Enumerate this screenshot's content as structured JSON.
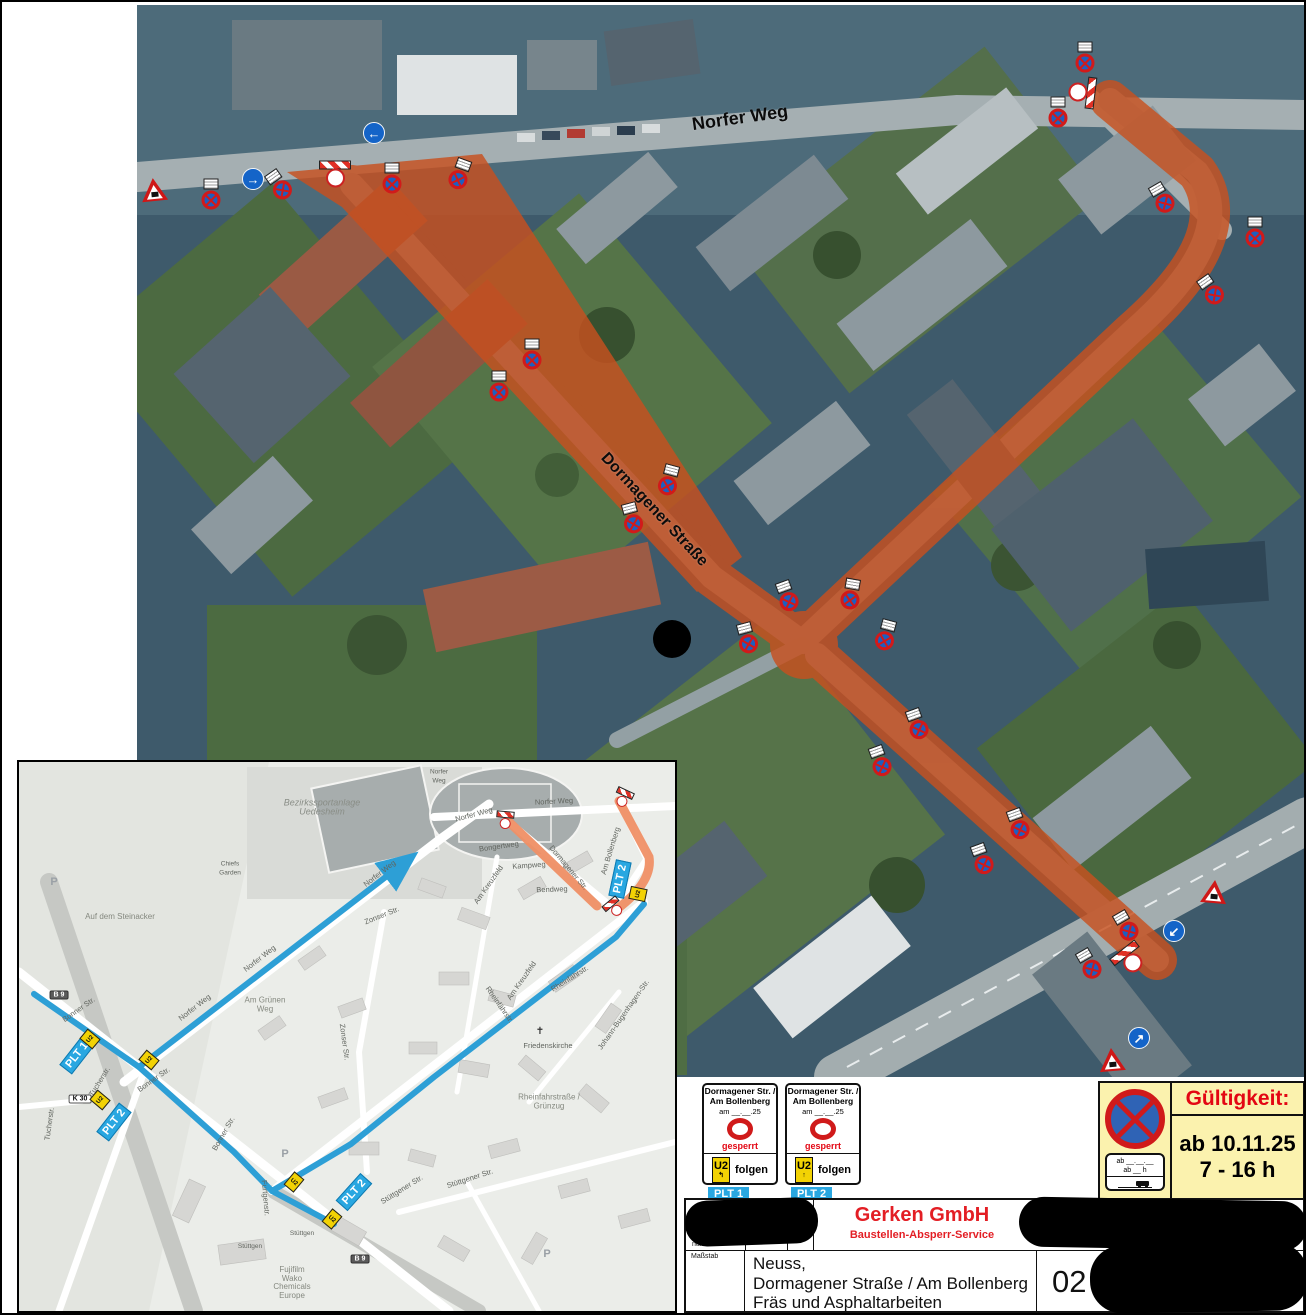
{
  "aerial": {
    "street_labels": [
      {
        "text": "Norfer Weg",
        "x": 738,
        "y": 116,
        "rot": -8,
        "size": 18
      },
      {
        "text": "Dormagener Straße",
        "x": 652,
        "y": 508,
        "rot": 47,
        "size": 16
      }
    ],
    "signs": [
      {
        "type": "triangle",
        "x": 152,
        "y": 188,
        "rot": -6
      },
      {
        "type": "nostop",
        "x": 209,
        "y": 192,
        "rot": 0,
        "plate": 1
      },
      {
        "type": "arrow",
        "x": 251,
        "y": 177,
        "dir": "→"
      },
      {
        "type": "nostop",
        "x": 277,
        "y": 183,
        "rot": -35,
        "plate": 1
      },
      {
        "type": "barrier",
        "x": 333,
        "y": 172,
        "rot": 0,
        "circle": 1
      },
      {
        "type": "nostop",
        "x": 390,
        "y": 176,
        "rot": 0,
        "plate": 1
      },
      {
        "type": "nostop",
        "x": 458,
        "y": 172,
        "rot": 20,
        "plate": 1
      },
      {
        "type": "arrow",
        "x": 372,
        "y": 131,
        "dir": "←"
      },
      {
        "type": "nostop",
        "x": 530,
        "y": 352,
        "rot": 0,
        "plate": 1
      },
      {
        "type": "nostop",
        "x": 497,
        "y": 384,
        "rot": 0,
        "plate": 1
      },
      {
        "type": "nostop",
        "x": 667,
        "y": 478,
        "rot": 15,
        "plate": 1
      },
      {
        "type": "nostop",
        "x": 630,
        "y": 516,
        "rot": -15,
        "plate": 1
      },
      {
        "type": "nostop",
        "x": 785,
        "y": 594,
        "rot": -20,
        "plate": 1
      },
      {
        "type": "nostop",
        "x": 849,
        "y": 592,
        "rot": 10,
        "plate": 1
      },
      {
        "type": "nostop",
        "x": 745,
        "y": 636,
        "rot": -15,
        "plate": 1
      },
      {
        "type": "nostop",
        "x": 884,
        "y": 633,
        "rot": 15,
        "plate": 1
      },
      {
        "type": "nostop",
        "x": 915,
        "y": 722,
        "rot": -20,
        "plate": 1
      },
      {
        "type": "nostop",
        "x": 878,
        "y": 759,
        "rot": -20,
        "plate": 1
      },
      {
        "type": "nostop",
        "x": 1016,
        "y": 822,
        "rot": -20,
        "plate": 1
      },
      {
        "type": "nostop",
        "x": 980,
        "y": 857,
        "rot": -20,
        "plate": 1
      },
      {
        "type": "nostop",
        "x": 1083,
        "y": 55,
        "rot": 0,
        "plate": 1
      },
      {
        "type": "barrier",
        "x": 1080,
        "y": 90,
        "rot": 97,
        "circle": 1
      },
      {
        "type": "nostop",
        "x": 1056,
        "y": 110,
        "rot": 0,
        "plate": 1
      },
      {
        "type": "nostop",
        "x": 1160,
        "y": 196,
        "rot": -30,
        "plate": 1
      },
      {
        "type": "nostop",
        "x": 1253,
        "y": 230,
        "rot": 0,
        "plate": 1
      },
      {
        "type": "nostop",
        "x": 1209,
        "y": 288,
        "rot": -35,
        "plate": 1
      },
      {
        "type": "triangle",
        "x": 1212,
        "y": 890,
        "rot": 5
      },
      {
        "type": "arrow",
        "x": 1172,
        "y": 929,
        "dir": "↙"
      },
      {
        "type": "nostop",
        "x": 1124,
        "y": 924,
        "rot": -30,
        "plate": 1
      },
      {
        "type": "barrier",
        "x": 1128,
        "y": 958,
        "rot": -38,
        "circle": 1
      },
      {
        "type": "nostop",
        "x": 1087,
        "y": 962,
        "rot": -30,
        "plate": 1
      },
      {
        "type": "arrow",
        "x": 1137,
        "y": 1036,
        "dir": "↗"
      },
      {
        "type": "triangle",
        "x": 1110,
        "y": 1058,
        "rot": -5
      },
      {
        "type": "dot",
        "x": 670,
        "y": 637
      }
    ]
  },
  "inset": {
    "labels": [
      {
        "text": "Bezirkssportanlage\nUedesheim",
        "x": 320,
        "y": 805,
        "cls": "area"
      },
      {
        "text": "Chiefs\nGarden",
        "x": 228,
        "y": 867,
        "cls": "tiny"
      },
      {
        "text": "Auf dem Steinacker",
        "x": 118,
        "y": 915,
        "cls": "area2"
      },
      {
        "text": "Am Grünen\nWeg",
        "x": 263,
        "y": 1003,
        "cls": "area2"
      },
      {
        "text": "Norfer Weg",
        "x": 552,
        "y": 800,
        "rot": -3
      },
      {
        "text": "Norfer Weg",
        "x": 472,
        "y": 813,
        "rot": -15
      },
      {
        "text": "Norfer Weg",
        "x": 378,
        "y": 872,
        "rot": -38
      },
      {
        "text": "Norfer Weg",
        "x": 258,
        "y": 957,
        "rot": -38
      },
      {
        "text": "Norfer Weg",
        "x": 193,
        "y": 1006,
        "rot": -38
      },
      {
        "text": "Bongertweg",
        "x": 497,
        "y": 845,
        "rot": -8
      },
      {
        "text": "Kampweg",
        "x": 527,
        "y": 864,
        "rot": -4
      },
      {
        "text": "Bendweg",
        "x": 550,
        "y": 888,
        "rot": -2
      },
      {
        "text": "Dormagener Str.",
        "x": 566,
        "y": 866,
        "rot": 50
      },
      {
        "text": "Am Bollenberg",
        "x": 609,
        "y": 849,
        "rot": -73
      },
      {
        "text": "Am Kreuzfeld",
        "x": 487,
        "y": 883,
        "rot": -55
      },
      {
        "text": "Am Kreuzfeld",
        "x": 520,
        "y": 979,
        "rot": -55
      },
      {
        "text": "Zonser Str.",
        "x": 380,
        "y": 914,
        "rot": -22
      },
      {
        "text": "Zonser Str.",
        "x": 342,
        "y": 1040,
        "rot": 82
      },
      {
        "text": "Rheinfährstr.",
        "x": 568,
        "y": 977,
        "rot": -32
      },
      {
        "text": "Rheinfährstr.",
        "x": 497,
        "y": 1003,
        "rot": 55
      },
      {
        "text": "Friedenskirche",
        "x": 546,
        "y": 1044,
        "rot": 0
      },
      {
        "text": "✝",
        "x": 538,
        "y": 1030,
        "cls": "church"
      },
      {
        "text": "Johann-Bugenhagen-Str.",
        "x": 622,
        "y": 1013,
        "rot": -55
      },
      {
        "text": "Rheinfahrstraße /\nGrünzug",
        "x": 547,
        "y": 1100,
        "cls": "area2"
      },
      {
        "text": "Bonner Str.",
        "x": 77,
        "y": 1008,
        "rot": -35
      },
      {
        "text": "Bonner Str.",
        "x": 152,
        "y": 1078,
        "rot": -35
      },
      {
        "text": "Bonner Str.",
        "x": 222,
        "y": 1132,
        "rot": -60
      },
      {
        "text": "Tucherstr.",
        "x": 98,
        "y": 1080,
        "rot": -58
      },
      {
        "text": "Tucherstr.",
        "x": 48,
        "y": 1122,
        "rot": -82
      },
      {
        "text": "Stüttgen",
        "x": 300,
        "y": 1232,
        "cls": "tiny"
      },
      {
        "text": "Stüttgen",
        "x": 248,
        "y": 1245,
        "cls": "tiny"
      },
      {
        "text": "Stüttgener Str.",
        "x": 400,
        "y": 1188,
        "rot": -32
      },
      {
        "text": "Stüttgener Str.",
        "x": 468,
        "y": 1177,
        "rot": -18
      },
      {
        "text": "Furtgenstr.",
        "x": 263,
        "y": 1196,
        "rot": 85
      },
      {
        "text": "Fujifilm\nWako\nChemicals\nEurope",
        "x": 290,
        "y": 1281,
        "cls": "area2"
      },
      {
        "text": "P",
        "x": 52,
        "y": 880,
        "cls": "pk"
      },
      {
        "text": "P",
        "x": 283,
        "y": 1152,
        "cls": "pk"
      },
      {
        "text": "P",
        "x": 545,
        "y": 1252,
        "cls": "pk"
      },
      {
        "text": "Norfer\nWeg",
        "x": 437,
        "y": 775,
        "cls": "tiny"
      }
    ],
    "badges": [
      {
        "text": "B 9",
        "x": 57,
        "y": 993,
        "cls": "b9"
      },
      {
        "text": "B 9",
        "x": 358,
        "y": 1257,
        "cls": "b9"
      },
      {
        "text": "K 30",
        "x": 78,
        "y": 1097,
        "cls": "k30"
      }
    ],
    "plt_badges": [
      {
        "text": "PLT 1",
        "x": 75,
        "y": 1053,
        "rot": -52
      },
      {
        "text": "PLT 2",
        "x": 112,
        "y": 1120,
        "rot": -52
      },
      {
        "text": "PLT 2",
        "x": 618,
        "y": 877,
        "rot": -78
      },
      {
        "text": "PLT 2",
        "x": 352,
        "y": 1190,
        "rot": -48
      }
    ],
    "u2_markers": [
      {
        "x": 88,
        "y": 1037,
        "rot": -50
      },
      {
        "x": 147,
        "y": 1058,
        "rot": -50
      },
      {
        "x": 98,
        "y": 1098,
        "rot": -50
      },
      {
        "x": 292,
        "y": 1180,
        "rot": 40
      },
      {
        "x": 330,
        "y": 1217,
        "rot": 40
      },
      {
        "x": 636,
        "y": 892,
        "rot": -78
      }
    ],
    "barriers": [
      {
        "x": 503,
        "y": 818,
        "rot": 5
      },
      {
        "x": 621,
        "y": 796,
        "rot": 25
      },
      {
        "x": 612,
        "y": 906,
        "rot": -40
      }
    ],
    "u2_text": "U2"
  },
  "panels": {
    "items": [
      {
        "title1": "Dormagener Str. /",
        "title2": "Am Bollenberg",
        "date_line": "am __.__.25",
        "status": "gesperrt",
        "u2": "U2",
        "arrow": "↰",
        "follow": "folgen",
        "badge": "PLT 1"
      },
      {
        "title1": "Dormagener Str. /",
        "title2": "Am Bollenberg",
        "date_line": "am __.__.25",
        "status": "gesperrt",
        "u2": "U2",
        "arrow": "↑",
        "follow": "folgen",
        "badge": "PLT 2"
      }
    ]
  },
  "validity": {
    "title": "Gültigkeit:",
    "line1": "ab 10.11.25",
    "line2": "7 - 16 h",
    "plate_line1": "ab __.__.__",
    "plate_line2": "ab __ h"
  },
  "titleblock": {
    "company": "Gerken GmbH",
    "dept": "Baustellen-Absperr-Service",
    "addr1": "In der Steele 8",
    "addr2": "40599 Düsseldorf",
    "addr3": "0211 / 73 77 690",
    "label_nummer": "nummer",
    "label_massstab": "Maßstab",
    "label_plannr": "Plan.Nr.",
    "plannr": "02",
    "city": "Neuss,",
    "street": "Dormagener Straße / Am Bollenberg",
    "work": "Fräs und Asphaltarbeiten"
  },
  "colors": {
    "closure_orange": "#c8501f",
    "detour_blue": "#2d9fd6",
    "plt_blue": "#29a7e1",
    "validity_yellow": "#fbf2ae",
    "brand_red": "#e31e24"
  }
}
